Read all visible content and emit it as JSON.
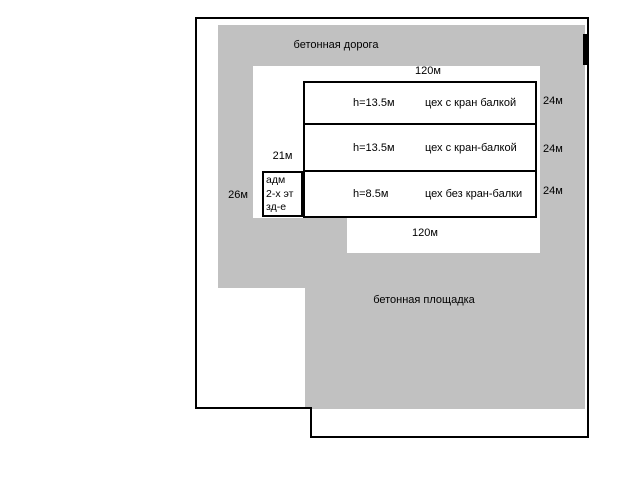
{
  "colors": {
    "concrete": "#c1c1c1",
    "boundary": "#000000",
    "background": "#ffffff"
  },
  "areas": {
    "road_label": "бетонная дорога",
    "pad_label": "бетонная площадка"
  },
  "dimensions": {
    "top_length": "120м",
    "bottom_length": "120м",
    "adm_strip_width": "21м",
    "left_width": "26м"
  },
  "building": {
    "rows": [
      {
        "height": "h=13.5м",
        "name": "цех с кран балкой",
        "depth": "24м"
      },
      {
        "height": "h=13.5м",
        "name": "цех с кран-балкой",
        "depth": "24м"
      },
      {
        "height": "h=8.5м",
        "name": "цех без кран-балки",
        "depth": "24м"
      }
    ]
  },
  "adm_building": {
    "lines": [
      "адм",
      "2-х эт",
      "зд-е"
    ]
  }
}
